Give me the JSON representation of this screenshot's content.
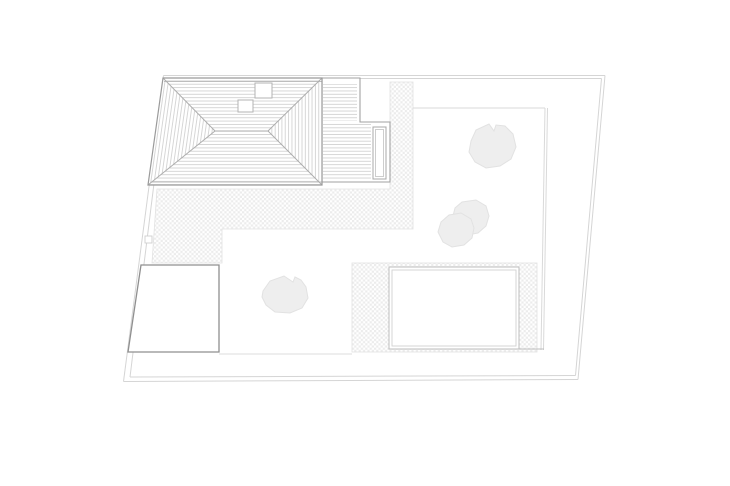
{
  "drawing": {
    "background": "#ffffff",
    "colors": {
      "background": "#ffffff",
      "boundary": "#d5d5d5",
      "fence": "#d9d9d9",
      "roof_outline": "#9a9a9a",
      "roof_hip": "#adadad",
      "roof_hatch": "#cdcdcd",
      "deck_outline": "#a2a2a2",
      "deck_board": "#cccccc",
      "planter_outline": "#a8a8a8",
      "planter_inner": "#c8c8c8",
      "skylight_outline": "#b3b3b3",
      "garage_outline": "#8f8f8f",
      "pool_border": "#bdbdbd",
      "pool_border_inner": "#d2d2d2",
      "gravel_dot": "#ececec",
      "gravel_edge": "#e2e2e2",
      "lawn_line": "#dcdcdc",
      "tree_fill": "#eeeeee",
      "tree_outline": "#e2e2e2"
    },
    "elements": [
      "plot-boundary",
      "gravel-terrace",
      "pool-gravel-surround",
      "swimming-pool",
      "garage",
      "wood-deck",
      "deck-planter",
      "hipped-house-roof",
      "roof-skylights",
      "garden-fence",
      "tree-large",
      "tree-double",
      "shrub"
    ]
  }
}
